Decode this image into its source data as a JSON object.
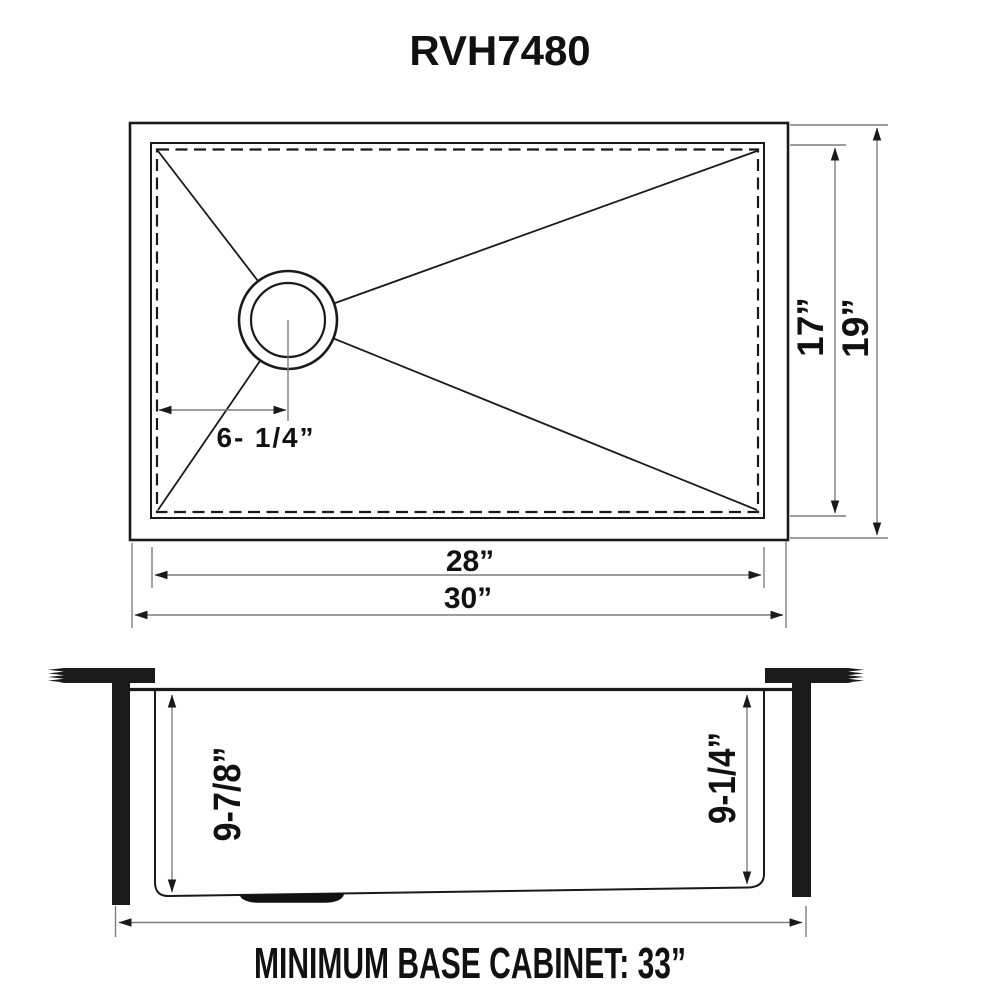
{
  "title": "RVH7480",
  "top_view": {
    "drain_offset": "6- 1/4”",
    "bowl_front_to_back": "17”",
    "overall_front_to_back": "19”",
    "bowl_width": "28”",
    "overall_width": "30”"
  },
  "side_view": {
    "bowl_depth_left": "9-7/8”",
    "bowl_depth_right": "9-1/4”",
    "base_cabinet_note": "MINIMUM BASE CABINET: 33”"
  },
  "colors": {
    "line": "#1a1a1a",
    "dimension_line": "#7d7d7d",
    "background": "#ffffff"
  }
}
